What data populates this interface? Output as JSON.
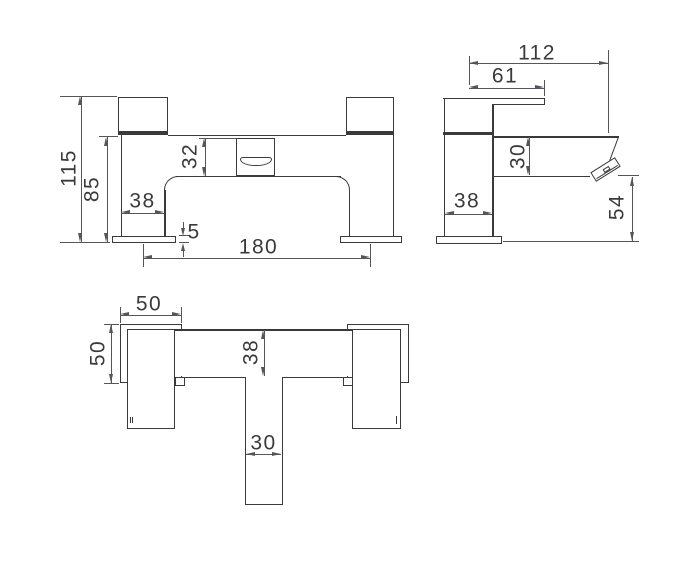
{
  "colors": {
    "line": "#3a3a3c",
    "dim_line": "#55555a",
    "text": "#3a3a3a",
    "background": "#ffffff"
  },
  "views": {
    "front": {
      "dims": {
        "overall_height": "115",
        "deck_to_underbody": "85",
        "spout_body_height": "32",
        "pillar_width": "38",
        "base_plate_thickness": "5",
        "pillar_centres": "180"
      }
    },
    "side": {
      "dims": {
        "overall_projection": "112",
        "handle_projection": "61",
        "spout_height": "30",
        "pillar_depth": "38",
        "spout_to_deck": "54"
      }
    },
    "plan": {
      "dims": {
        "handle_width": "50",
        "handle_length": "50",
        "body_depth": "38",
        "spout_width": "30"
      }
    }
  }
}
